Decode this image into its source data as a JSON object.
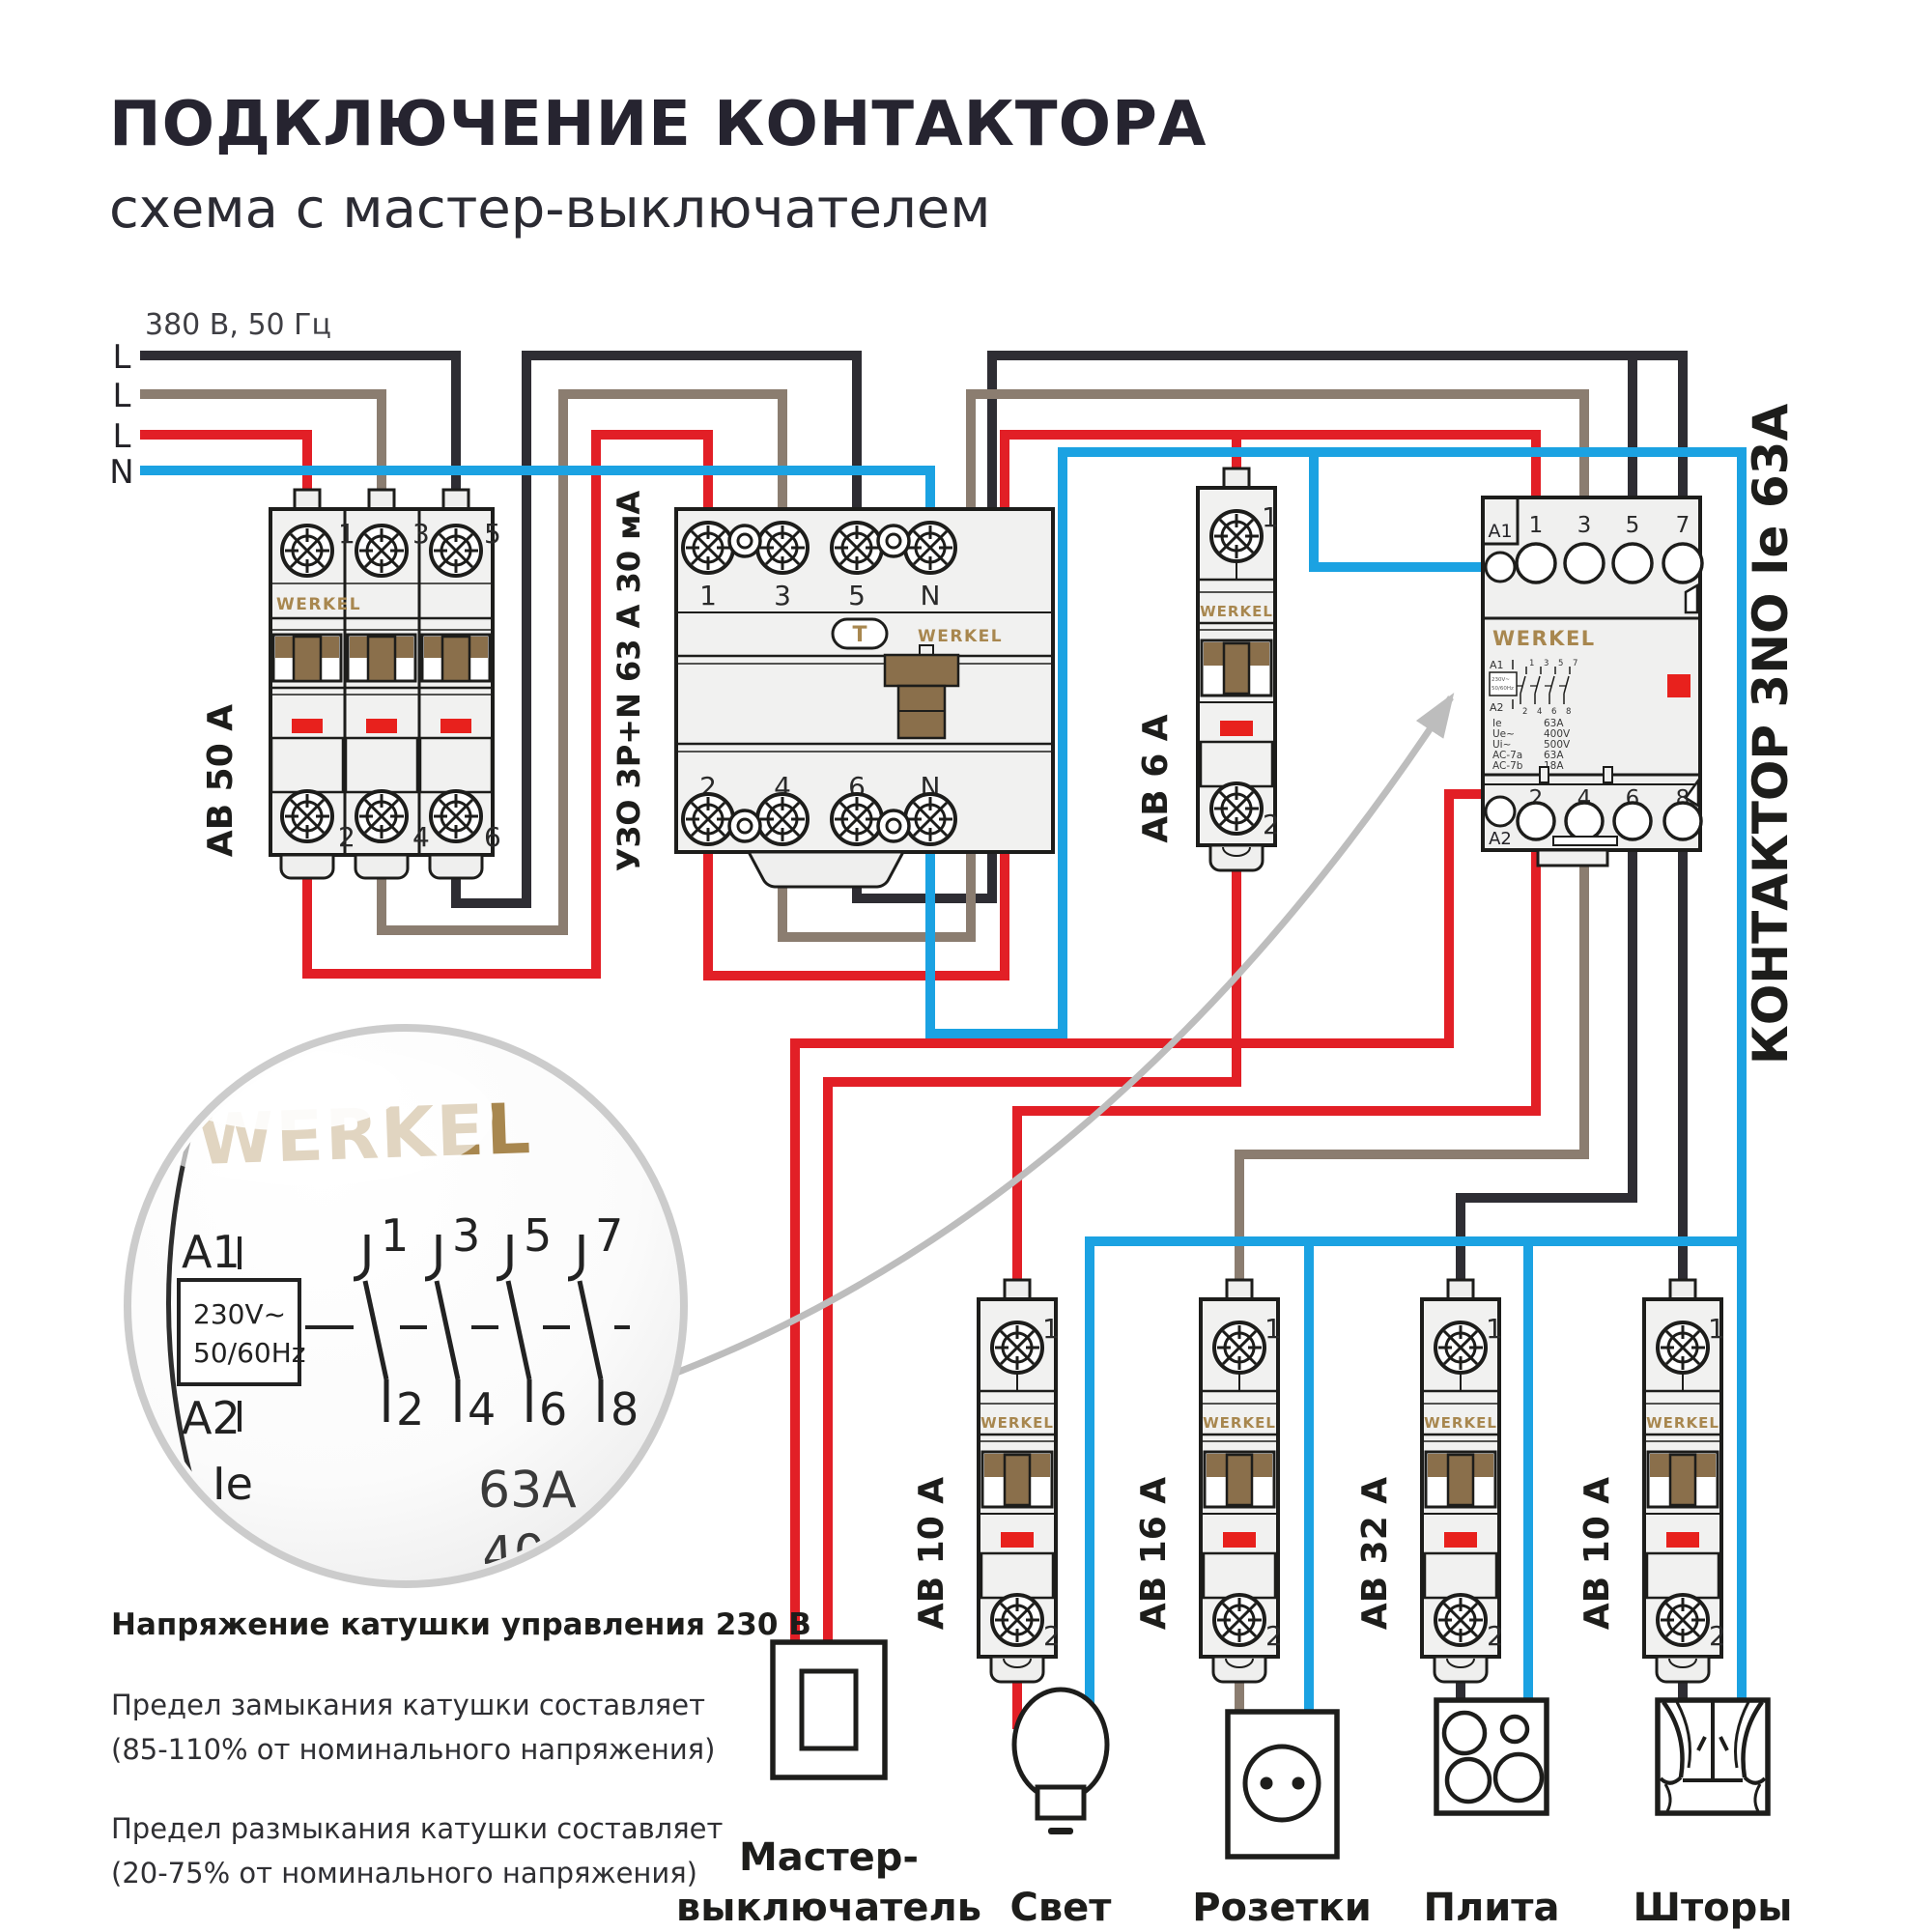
{
  "title": "ПОДКЛЮЧЕНИЕ КОНТАКТОРА",
  "subtitle": "схема с мастер-выключателем",
  "supply": {
    "rating": "380 В, 50 Гц",
    "lines": [
      "L",
      "L",
      "L",
      "N"
    ]
  },
  "colors": {
    "phase_black": "#2e2d33",
    "phase_brown": "#8b7d70",
    "phase_red": "#e21f26",
    "neutral_blue": "#1ba2e2",
    "brand_gold": "#a8874f",
    "indicator_red": "#e8211d",
    "device_fill": "#f1f1f0",
    "device_stroke": "#1d1d1b",
    "lever_brown": "#8a6f4b",
    "arrow_gray": "#bdbdbd"
  },
  "devices": {
    "ab50": {
      "label": "АВ 50 А",
      "brand": "WERKEL",
      "top_terminals": [
        "1",
        "3",
        "5"
      ],
      "bottom_terminals": [
        "2",
        "4",
        "6"
      ]
    },
    "uzo": {
      "label": "УЗО 3P+N 63 А 30 мА",
      "brand": "WERKEL",
      "test_button": "T",
      "top_terminals": [
        "1",
        "3",
        "5",
        "N"
      ],
      "bottom_terminals": [
        "2",
        "4",
        "6",
        "N"
      ]
    },
    "unit": {
      "brand": "WERKEL",
      "top_terminal": "1",
      "bottom_terminal": "2"
    },
    "ab6": {
      "label": "АВ 6 А"
    },
    "contactor": {
      "label": "КОНТАКТОР 3NO Ie 63А",
      "brand": "WERKEL",
      "coil_top": "A1",
      "coil_bottom": "A2",
      "coil_voltage": "230V~",
      "coil_freq": "50/60Hz",
      "top_terminals": [
        "1",
        "3",
        "5",
        "7"
      ],
      "bottom_terminals": [
        "2",
        "4",
        "6",
        "8"
      ],
      "specs": [
        {
          "k": "Ie",
          "v": "63A"
        },
        {
          "k": "Ue~",
          "v": "400V"
        },
        {
          "k": "Ui~",
          "v": "500V"
        },
        {
          "k": "AC-7a",
          "v": "63A"
        },
        {
          "k": "AC-7b",
          "v": "18A"
        }
      ]
    },
    "breakers": [
      {
        "label": "АВ 10 А"
      },
      {
        "label": "АВ 16 А"
      },
      {
        "label": "АВ 32 А"
      },
      {
        "label": "АВ 10 А"
      }
    ]
  },
  "magnifier": {
    "brand": "WERKEL",
    "coil_top": "A1",
    "coil_bottom": "A2",
    "coil_voltage": "230V~",
    "coil_freq": "50/60Hz",
    "top_contacts": [
      "1",
      "3",
      "5",
      "7"
    ],
    "bottom_contacts": [
      "2",
      "4",
      "6",
      "8"
    ],
    "spec_key": "Ie",
    "spec_value": "63A",
    "spec_voltage": "400V"
  },
  "loads": {
    "master": {
      "label_line1": "Мастер-",
      "label_line2": "выключатель"
    },
    "light": {
      "label": "Свет"
    },
    "sockets": {
      "label": "Розетки"
    },
    "stove": {
      "label": "Плита"
    },
    "curtains": {
      "label": "Шторы"
    }
  },
  "notes": {
    "heading": "Напряжение катушки управления 230 В",
    "close_line1": "Предел замыкания катушки составляет",
    "close_line2": "(85-110% от номинального напряжения)",
    "open_line1": "Предел размыкания катушки составляет",
    "open_line2": "(20-75% от номинального напряжения)"
  }
}
